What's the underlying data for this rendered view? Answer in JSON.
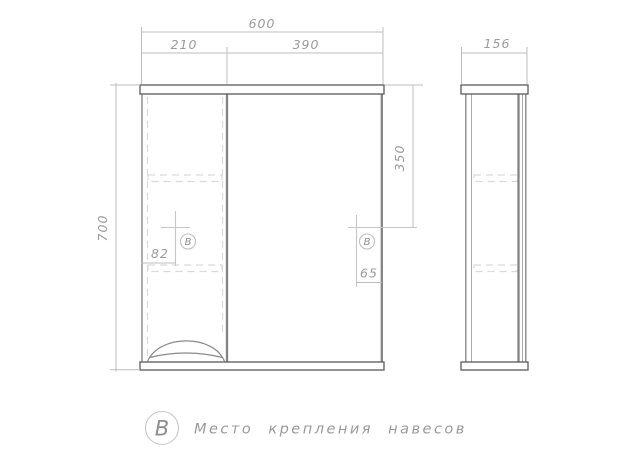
{
  "dimensions": {
    "overall_width": "600",
    "door_section_width": "210",
    "mirror_section_width": "390",
    "overall_height": "700",
    "hanger_offset_top": "350",
    "hanger_offset_left": "82",
    "hanger_offset_right": "65",
    "side_depth": "156"
  },
  "markers": {
    "left_symbol": "В",
    "right_symbol": "В"
  },
  "legend": {
    "symbol": "В",
    "description": "Место крепления навесов"
  },
  "colors": {
    "outline": "#5a5a5a",
    "body_line": "#8a8a8a",
    "hidden_line": "#dadada",
    "dimension_line": "#bdbdbd",
    "dimension_text": "#9b9b9b",
    "legend_text": "#9a9a9a"
  }
}
